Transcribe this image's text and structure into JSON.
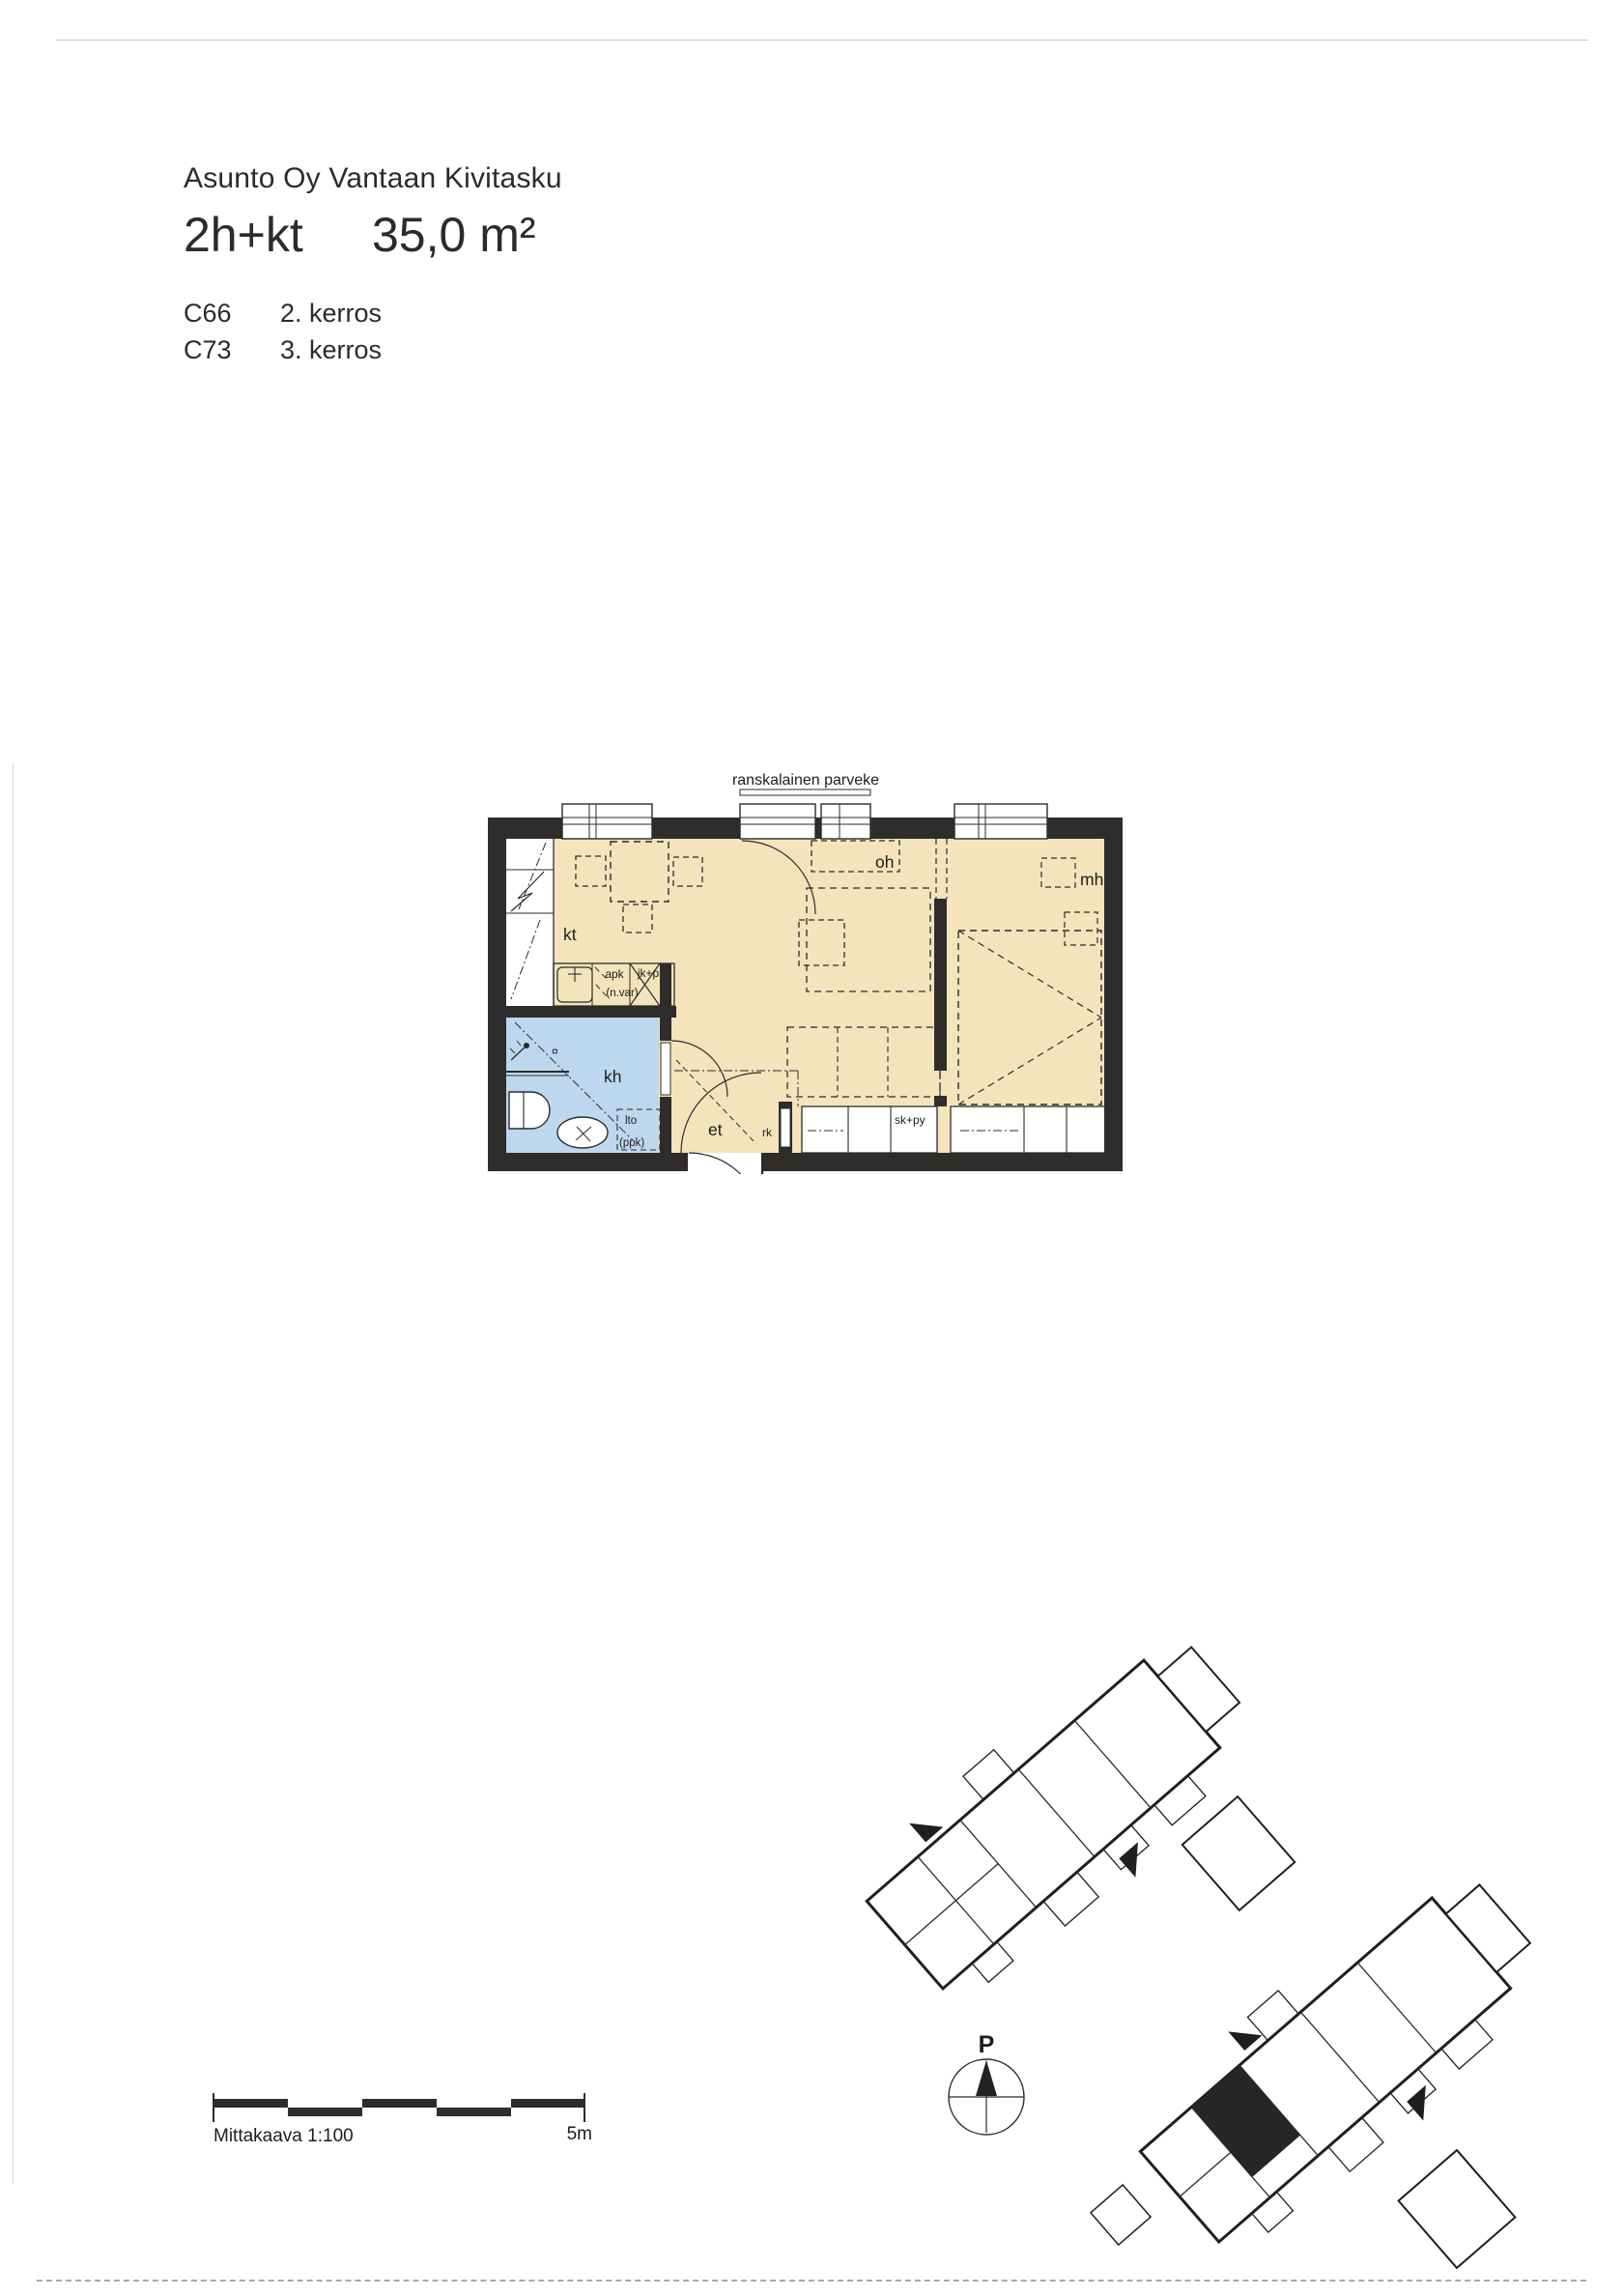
{
  "header": {
    "company": "Asunto Oy Vantaan Kivitasku",
    "apartment_type": "2h+kt",
    "area": "35,0 m²",
    "units": [
      {
        "code": "C66",
        "floor": "2. kerros"
      },
      {
        "code": "C73",
        "floor": "3. kerros"
      }
    ]
  },
  "floor_plan": {
    "balcony_label": "ranskalainen parveke",
    "room_labels": {
      "kitchen": "kt",
      "living": "oh",
      "bedroom": "mh",
      "bathroom": "kh",
      "entry": "et"
    },
    "fixture_labels": {
      "dishwasher": "apk",
      "fridge_freezer": "jk+pk",
      "reserve": "(n.var)",
      "heat_unit": "lto",
      "washer_reserve": "(ppk)",
      "pantry": "rk",
      "wardrobe": "sk+py",
      "drain": "¤"
    },
    "colors": {
      "room_fill": "#f4e4bc",
      "bathroom_fill": "#bdd8ee",
      "wall": "#2e2d2b"
    }
  },
  "site_plan": {
    "north_label": "P"
  },
  "scale_bar": {
    "scale_label": "Mittakaava 1:100",
    "max_label": "5m"
  }
}
